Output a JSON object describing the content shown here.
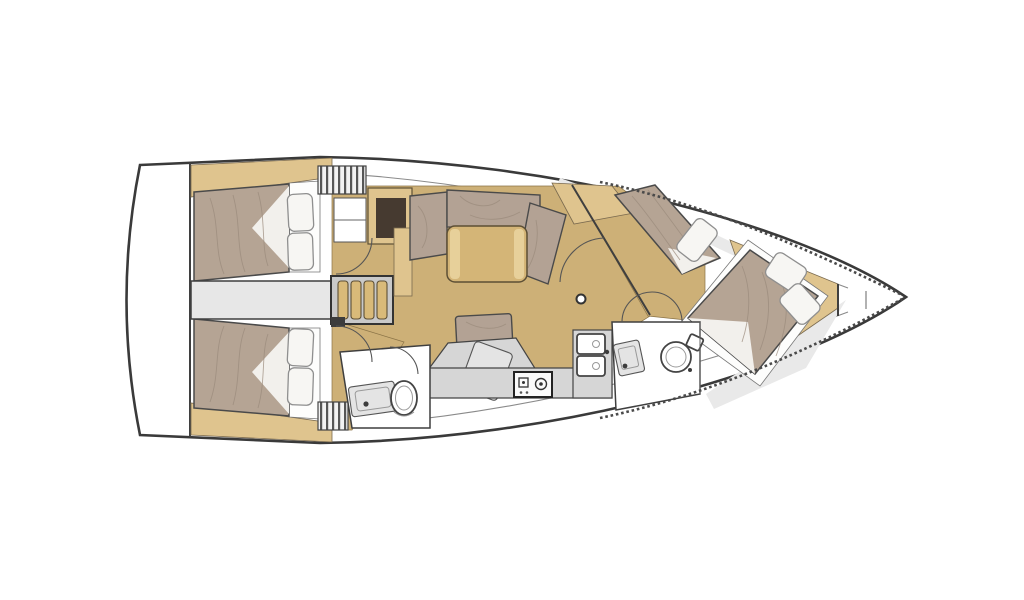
{
  "diagram": {
    "type": "sailing-yacht-interior-floor-plan",
    "view": "top-down",
    "bow_side": "right",
    "stern_side": "left",
    "visible_text": "",
    "rooms": [
      {
        "id": "aft-cabin-port",
        "features": [
          "double-berth",
          "pillows",
          "door-swing"
        ]
      },
      {
        "id": "aft-cabin-starboard",
        "features": [
          "double-berth",
          "pillows",
          "door-swing"
        ]
      },
      {
        "id": "saloon",
        "features": [
          "l-settee",
          "dinette-table",
          "bench-seat",
          "mast-post",
          "nav-desk"
        ]
      },
      {
        "id": "galley",
        "features": [
          "stove",
          "double-sink",
          "fridge-lid",
          "counter"
        ]
      },
      {
        "id": "aft-head",
        "features": [
          "toilet",
          "vanity-sink",
          "door-swing"
        ]
      },
      {
        "id": "forward-head",
        "features": [
          "toilet",
          "sink",
          "double-door-swing"
        ]
      },
      {
        "id": "forward-cabin",
        "features": [
          "diagonal-island-berth",
          "side-berth",
          "pillows"
        ]
      },
      {
        "id": "bow-locker",
        "features": [
          "chord-bulkheads"
        ]
      }
    ],
    "icons": [
      "toilet-icon",
      "sink-icon",
      "stove-icon",
      "double-sink-icon",
      "pillow",
      "companionway-steps",
      "louver-hatch",
      "door-swing-arc",
      "mast-post",
      "fridge-lid"
    ]
  },
  "palette": {
    "hull_fill": "#ffffff",
    "hull_outline": "#3a3a3a",
    "deck_gray": "#e9e9e9",
    "corridor_gray": "#e7e7e7",
    "floor_wood": "#cdb077",
    "wood_light": "#dfc48e",
    "steps_wood": "#d9ba79",
    "table_wood": "#d4b577",
    "mattress_taupe": "#b5a494",
    "sofa_taupe": "#b3a294",
    "pillow_white": "#f7f6f3",
    "counter_gray": "#d6d6d6",
    "fixture_white": "#ffffff",
    "niche_dark": "#463a30",
    "wall_dark": "#3f3f3f"
  }
}
